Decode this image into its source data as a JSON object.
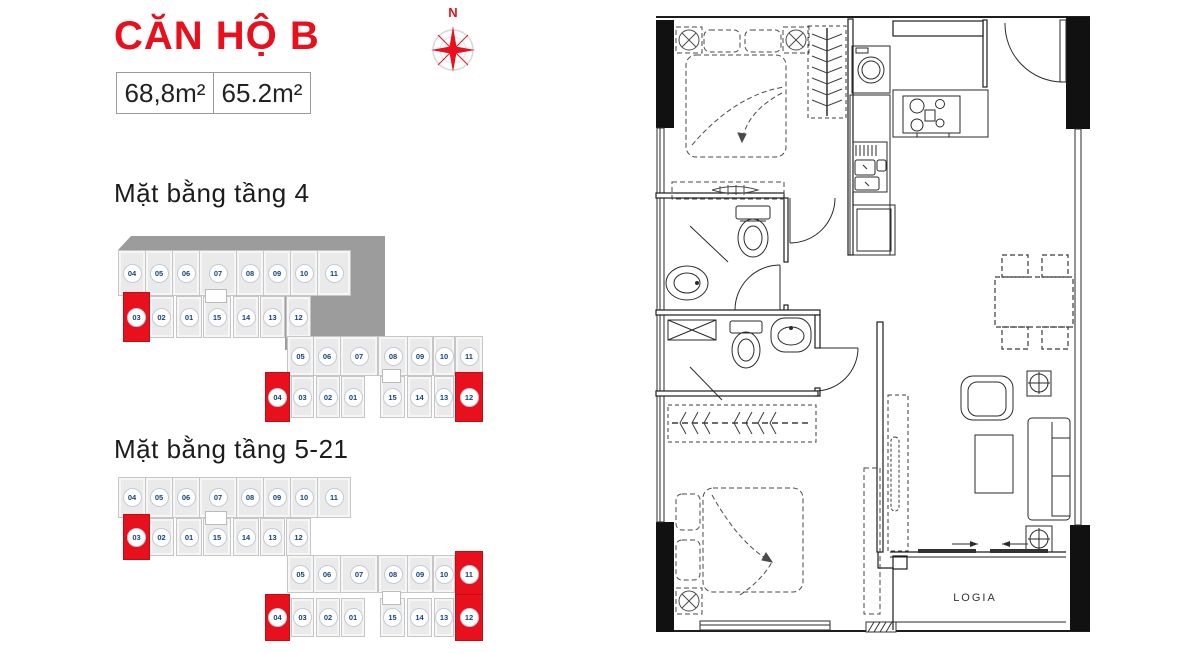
{
  "header": {
    "title": "CĂN HỘ B",
    "area_values": [
      "68,8m²",
      "65.2m²"
    ],
    "compass_label": "N"
  },
  "sections": [
    {
      "heading": "Mặt bằng tầng 4",
      "roof": true,
      "rows": {
        "L1": [
          {
            "n": "04"
          },
          {
            "n": "05"
          },
          {
            "n": "06"
          },
          {
            "n": "07"
          },
          {
            "n": "08"
          },
          {
            "n": "09"
          },
          {
            "n": "10"
          },
          {
            "n": "11"
          }
        ],
        "L2": [
          {
            "n": "03",
            "hl": true
          },
          {
            "n": "02"
          },
          {
            "n": "01"
          },
          {
            "n": "15"
          },
          {
            "n": "14"
          },
          {
            "n": "13"
          },
          {
            "n": "12"
          }
        ],
        "R1": [
          {
            "n": "05"
          },
          {
            "n": "06"
          },
          {
            "n": "07"
          },
          {
            "n": "08"
          },
          {
            "n": "09"
          },
          {
            "n": "10"
          },
          {
            "n": "11"
          }
        ],
        "R2": [
          {
            "n": "04",
            "hl": true
          },
          {
            "n": "03"
          },
          {
            "n": "02"
          },
          {
            "n": "01"
          },
          {
            "n": "15"
          },
          {
            "n": "14"
          },
          {
            "n": "13"
          },
          {
            "n": "12",
            "hl": true
          }
        ]
      }
    },
    {
      "heading": "Mặt bằng tầng 5-21",
      "roof": false,
      "rows": {
        "L1": [
          {
            "n": "04"
          },
          {
            "n": "05"
          },
          {
            "n": "06"
          },
          {
            "n": "07"
          },
          {
            "n": "08"
          },
          {
            "n": "09"
          },
          {
            "n": "10"
          },
          {
            "n": "11"
          }
        ],
        "L2": [
          {
            "n": "03",
            "hl": true
          },
          {
            "n": "02"
          },
          {
            "n": "01"
          },
          {
            "n": "15"
          },
          {
            "n": "14"
          },
          {
            "n": "13"
          },
          {
            "n": "12"
          }
        ],
        "R1": [
          {
            "n": "05"
          },
          {
            "n": "06"
          },
          {
            "n": "07"
          },
          {
            "n": "08"
          },
          {
            "n": "09"
          },
          {
            "n": "10"
          },
          {
            "n": "11",
            "hl": true
          }
        ],
        "R2": [
          {
            "n": "04",
            "hl": true
          },
          {
            "n": "03"
          },
          {
            "n": "02"
          },
          {
            "n": "01"
          },
          {
            "n": "15"
          },
          {
            "n": "14"
          },
          {
            "n": "13"
          },
          {
            "n": "12",
            "hl": true
          }
        ]
      }
    }
  ],
  "plan": {
    "logia_label": "LOGIA"
  },
  "colors": {
    "accent_red": "#e8101c",
    "unit_navy": "#15437d",
    "roof_gray": "#9c9c9c",
    "cell_fill": "#eaeaea"
  }
}
